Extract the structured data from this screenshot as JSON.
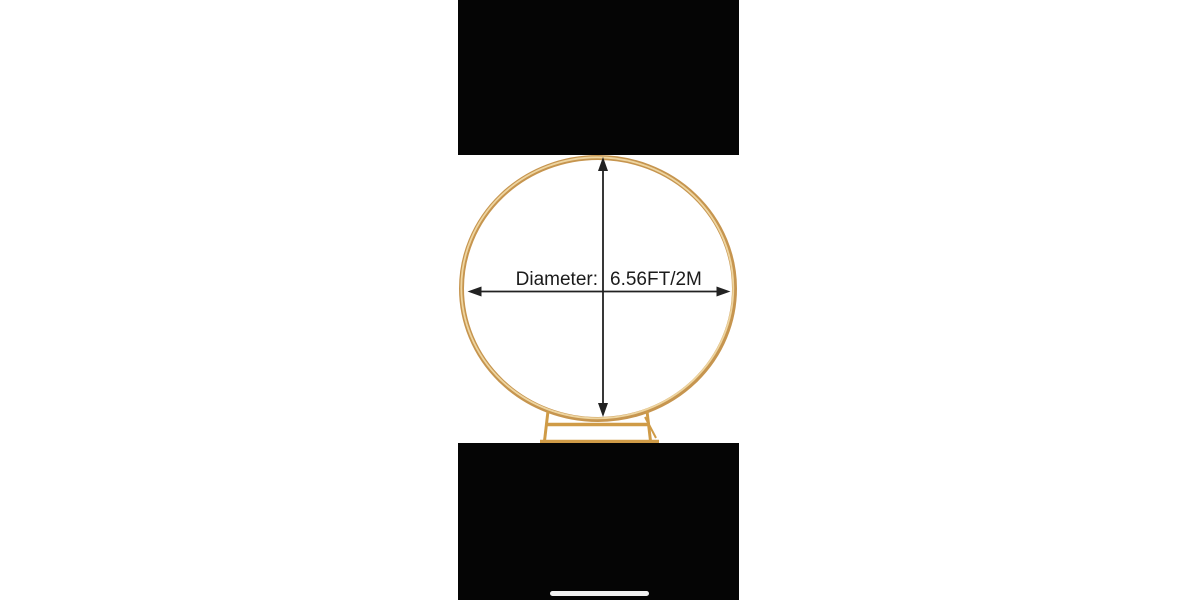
{
  "figure": {
    "measurement": {
      "label": "Diameter:",
      "value": "6.56FT/2M"
    }
  },
  "icons": {
    "ring": "gold-circle-arch-frame",
    "stand": "arch-base-stand",
    "vertical_arrow": "double-headed-vertical-arrow",
    "horizontal_arrow": "double-headed-horizontal-arrow",
    "home_indicator": "home-indicator-bar"
  },
  "colors": {
    "background": "#ffffff",
    "letterbox_black": "#050505",
    "ring_gold": "#c6954f",
    "ring_highlight": "#eed5a0",
    "stand_gold": "#cf9b47",
    "arrow": "#222222",
    "text": "#1b1b1b",
    "home_indicator": "#f2f2f2"
  }
}
